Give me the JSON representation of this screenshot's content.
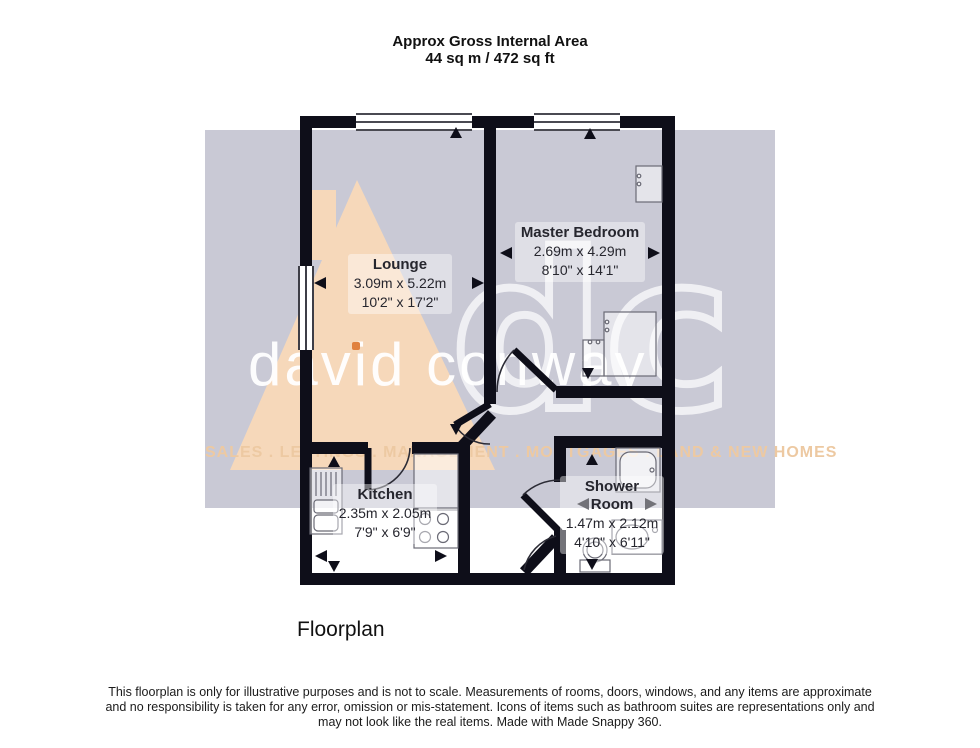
{
  "title": {
    "line1": "Approx Gross Internal Area",
    "line2": "44 sq m / 472 sq ft"
  },
  "rooms": [
    {
      "name": "Lounge",
      "metric": "3.09m x 5.22m",
      "imperial": "10'2\" x 17'2\""
    },
    {
      "name": "Master Bedroom",
      "metric": "2.69m x 4.29m",
      "imperial": "8'10\" x 14'1\""
    },
    {
      "name": "Kitchen",
      "metric": "2.35m x 2.05m",
      "imperial": "7'9\" x 6'9\""
    },
    {
      "name": "Shower Room",
      "metric": "1.47m x 2.12m",
      "imperial": "4'10\" x 6'11\""
    }
  ],
  "watermark": {
    "monogram": "dc",
    "brand": "david conway",
    "tagline": "SALES . LETTINGS . MANAGEMENT . MORTGAGES . LAND & NEW HOMES",
    "colors": {
      "panel": "#c9c9d5",
      "house": "#f6d8ba",
      "tagline": "#edc9a2",
      "accent": "#e0813f"
    }
  },
  "caption": "Floorplan",
  "disclaimer": {
    "line1": "This floorplan is only for illustrative purposes and is not to scale. Measurements of rooms, doors, windows, and any items are approximate",
    "line2": "and no responsibility is taken for any error, omission or mis-statement. Icons of items such as bathroom suites are representations only and",
    "line3": "may not look like the real items. Made with Made Snappy 360."
  },
  "plan_colors": {
    "wall": "#0e0e19"
  }
}
